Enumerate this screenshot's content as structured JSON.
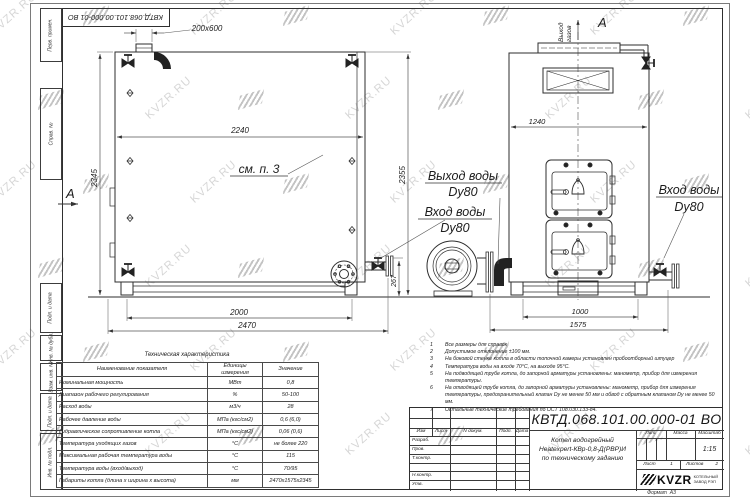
{
  "watermark": {
    "text": "KVZR.RU"
  },
  "margin": {
    "labels": [
      "Перв. примен.",
      "Справ. №",
      "Подп. и дата",
      "Инв. № дубл.",
      "Взам. инв. №",
      "Подп. и дата",
      "Инв. № подл."
    ]
  },
  "views": {
    "side": {
      "section_letter": "А",
      "see_note": "см. п. 3",
      "dims": {
        "duct": "200x600",
        "width_top": "2240",
        "height_left": "2345",
        "height_right": "2355",
        "base_span": "2000",
        "overall_length": "2470",
        "outlet_height": "267"
      }
    },
    "front": {
      "view_letter": "А",
      "gas_outlet_line1": "Выход",
      "gas_outlet_line2": "газов",
      "water_outlet_label": "Выход воды",
      "water_outlet_dn": "Dy80",
      "water_inlet_left_label": "Вход воды",
      "water_inlet_left_dn": "Dy80",
      "water_inlet_right_label": "Вход воды",
      "water_inlet_right_dn": "Dy80",
      "dims": {
        "width": "1240",
        "base_span": "1000",
        "overall": "1575"
      }
    }
  },
  "notes": [
    {
      "n": "1",
      "text": "Все размеры для справок"
    },
    {
      "n": "2",
      "text": "Допустимое отклонение ±100 мм."
    },
    {
      "n": "3",
      "text": "На боковой стенке котла в области топочной камеры установлен пробоотборный штуцер"
    },
    {
      "n": "4",
      "text": "Температура воды на входе 70°С, на выходе 95°С."
    },
    {
      "n": "5",
      "text": "На подводящей трубе котла, до запорной арматуры установлены: манометр, прибор для измерения температуры."
    },
    {
      "n": "6",
      "text": "На отводящей трубе котла, до запорной арматуры установлены: манометр, прибор для измерения температуры, предохранительный клапан Dу не менее 50 мм и обвод с обратным клапаном Dу не менее 50 мм."
    },
    {
      "n": "7",
      "text": "Остальные технические требования по ОСТ 108.030.133-84."
    }
  ],
  "table": {
    "title": "Техническая характеристика",
    "headers": [
      "Наименование показателя",
      "Единицы измерения",
      "Значение"
    ],
    "rows": [
      [
        "Номинальная мощность",
        "МВт",
        "0,8"
      ],
      [
        "Диапазон рабочего регулирования",
        "%",
        "50-100"
      ],
      [
        "Расход воды",
        "м3/ч",
        "28"
      ],
      [
        "Рабочее давление воды",
        "МПа (кгс/см2)",
        "0,6 (6,0)"
      ],
      [
        "Гидравлическое сопротивление котла",
        "МПа (кгс/см2)",
        "0,06 (0,6)"
      ],
      [
        "Температура уходящих газов",
        "°С",
        "не более 220"
      ],
      [
        "Максимальная рабочая температура воды",
        "°С",
        "115"
      ],
      [
        "Температура воды (вход/выход)",
        "°С",
        "70/95"
      ],
      [
        "Габариты котла (длина х ширина х высота)",
        "мм",
        "2470х1575х2345"
      ]
    ]
  },
  "title_block": {
    "doc_number": "КВТД.068.101.00.000-01 ВО",
    "cols": [
      "Изм",
      "Лист",
      "N докум.",
      "Подп.",
      "Дата"
    ],
    "sign_rows": [
      "Разраб.",
      "Пров.",
      "Т.контр.",
      "",
      "Н.контр.",
      "Утв."
    ],
    "name_line1": "Котел водогрейный",
    "name_line2": "Heatexpert-КВр-0,8-Д(РВР)И",
    "name_line3": "по техническому заданию",
    "lit_label": "Лит.",
    "mass_label": "Масса",
    "scale_label": "Масштаб",
    "scale_value": "1:15",
    "sheet_label": "Лист",
    "sheet_value": "1",
    "sheets_label": "Листов",
    "sheets_value": "2",
    "logo_text": "KVZR",
    "logo_sub1": "КОТЕЛЬНЫЙ",
    "logo_sub2": "ЗАВОД РЭП",
    "format_label": "Формат",
    "format_value": "А3"
  }
}
